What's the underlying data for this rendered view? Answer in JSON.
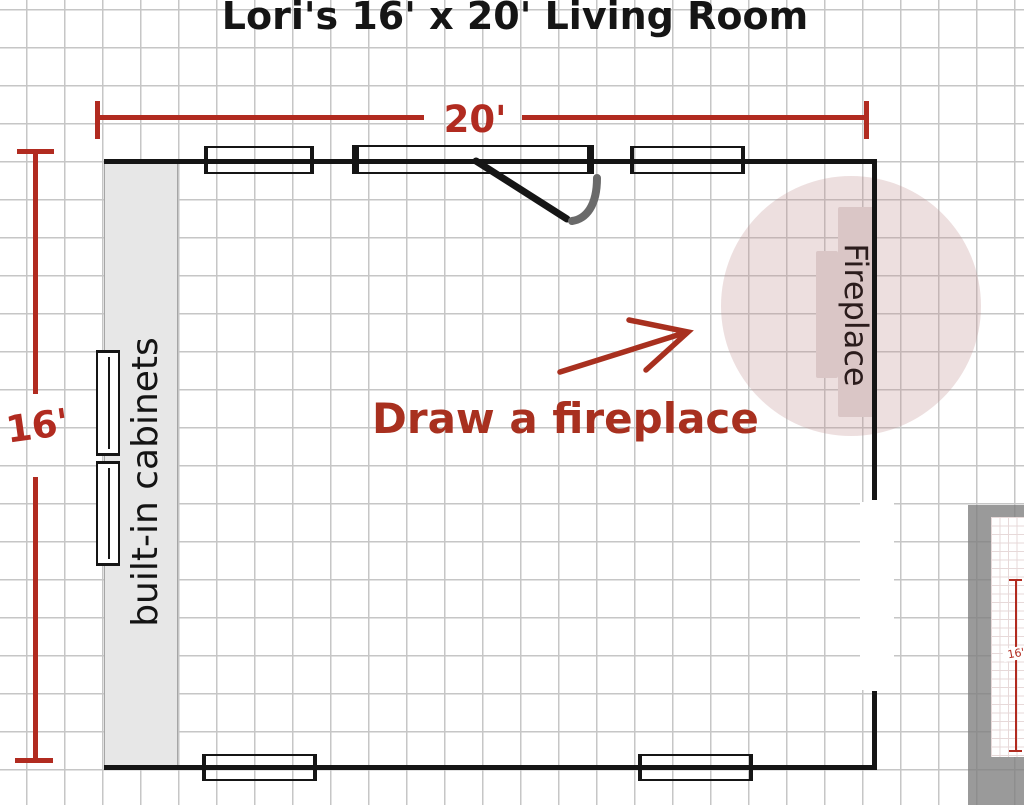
{
  "title": "Lori's 16' x 20' Living Room",
  "dimensions": {
    "top_label": "20'",
    "left_label": "16'"
  },
  "room": {
    "cabinets_label": "built-in cabinets",
    "fireplace_label": "Fireplace"
  },
  "annotation": {
    "text": "Draw a fireplace"
  },
  "inset": {
    "dim_label": "16'"
  },
  "colors": {
    "wall_black": "#151515",
    "grid_gray": "#c6c6c6",
    "dim_red": "#b12b20",
    "annotation_red": "#a8301f",
    "highlight_pink": "rgba(190,140,140,0.28)",
    "fireplace_fill": "#dac6c6",
    "cabinet_fill": "#e7e7e7",
    "door_arc_gray": "#6a6a6a"
  }
}
